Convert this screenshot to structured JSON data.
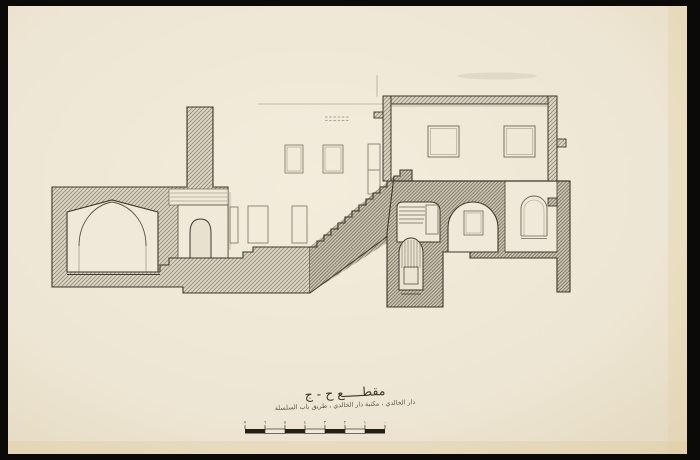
{
  "document": {
    "title_ar": "مقطـــــع  ح - ج",
    "subtitle_ar": "دار الخالدي ، مكتبة دار الخالدي ، طريق باب السلسلة"
  },
  "scale_bar": {
    "segments": 7,
    "tick_labels": [
      "٧",
      "٦",
      "٥",
      "٤",
      "٣",
      "٢",
      "١",
      "٠"
    ]
  },
  "palette": {
    "frame": "#0b0a08",
    "paper": "#f0e9d9",
    "paper_edge": "#e4d9c0",
    "ink": "#3b372d",
    "hatch_line": "#8a8170",
    "hatch_dark": "#776d5b",
    "warm_edge": "#dfc795"
  }
}
